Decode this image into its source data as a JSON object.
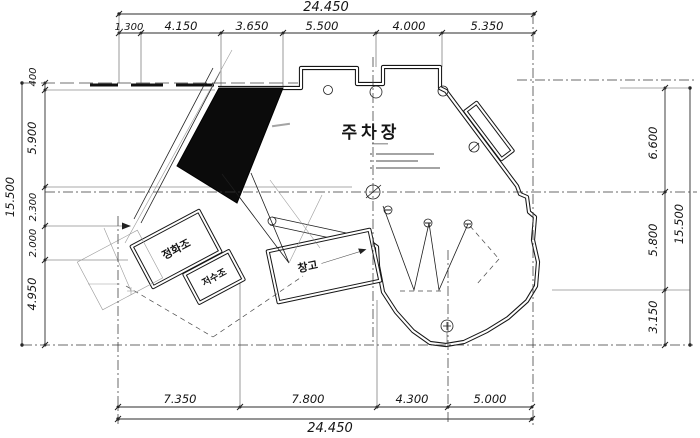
{
  "plan": {
    "labels": {
      "parking": "주차장",
      "septic_tank": "정화조",
      "water_tank": "저수조",
      "storage": "창고"
    },
    "dims": {
      "top_total": "24.450",
      "top": [
        "1.300",
        "4.150",
        "3.650",
        "5.500",
        "4.000",
        "5.350"
      ],
      "left": [
        "400",
        "5.900",
        "2.300",
        "2.000",
        "4.950"
      ],
      "left_total": "15.500",
      "right": [
        "6.600",
        "5.800",
        "3.150"
      ],
      "right_total": "15.500",
      "bottom": [
        "7.350",
        "7.800",
        "4.300",
        "5.000"
      ],
      "bottom_total": "24.450"
    },
    "colors": {
      "ink": "#1c1c1c",
      "paper": "#ffffff",
      "solid_fill": "#0b0b0b"
    }
  }
}
